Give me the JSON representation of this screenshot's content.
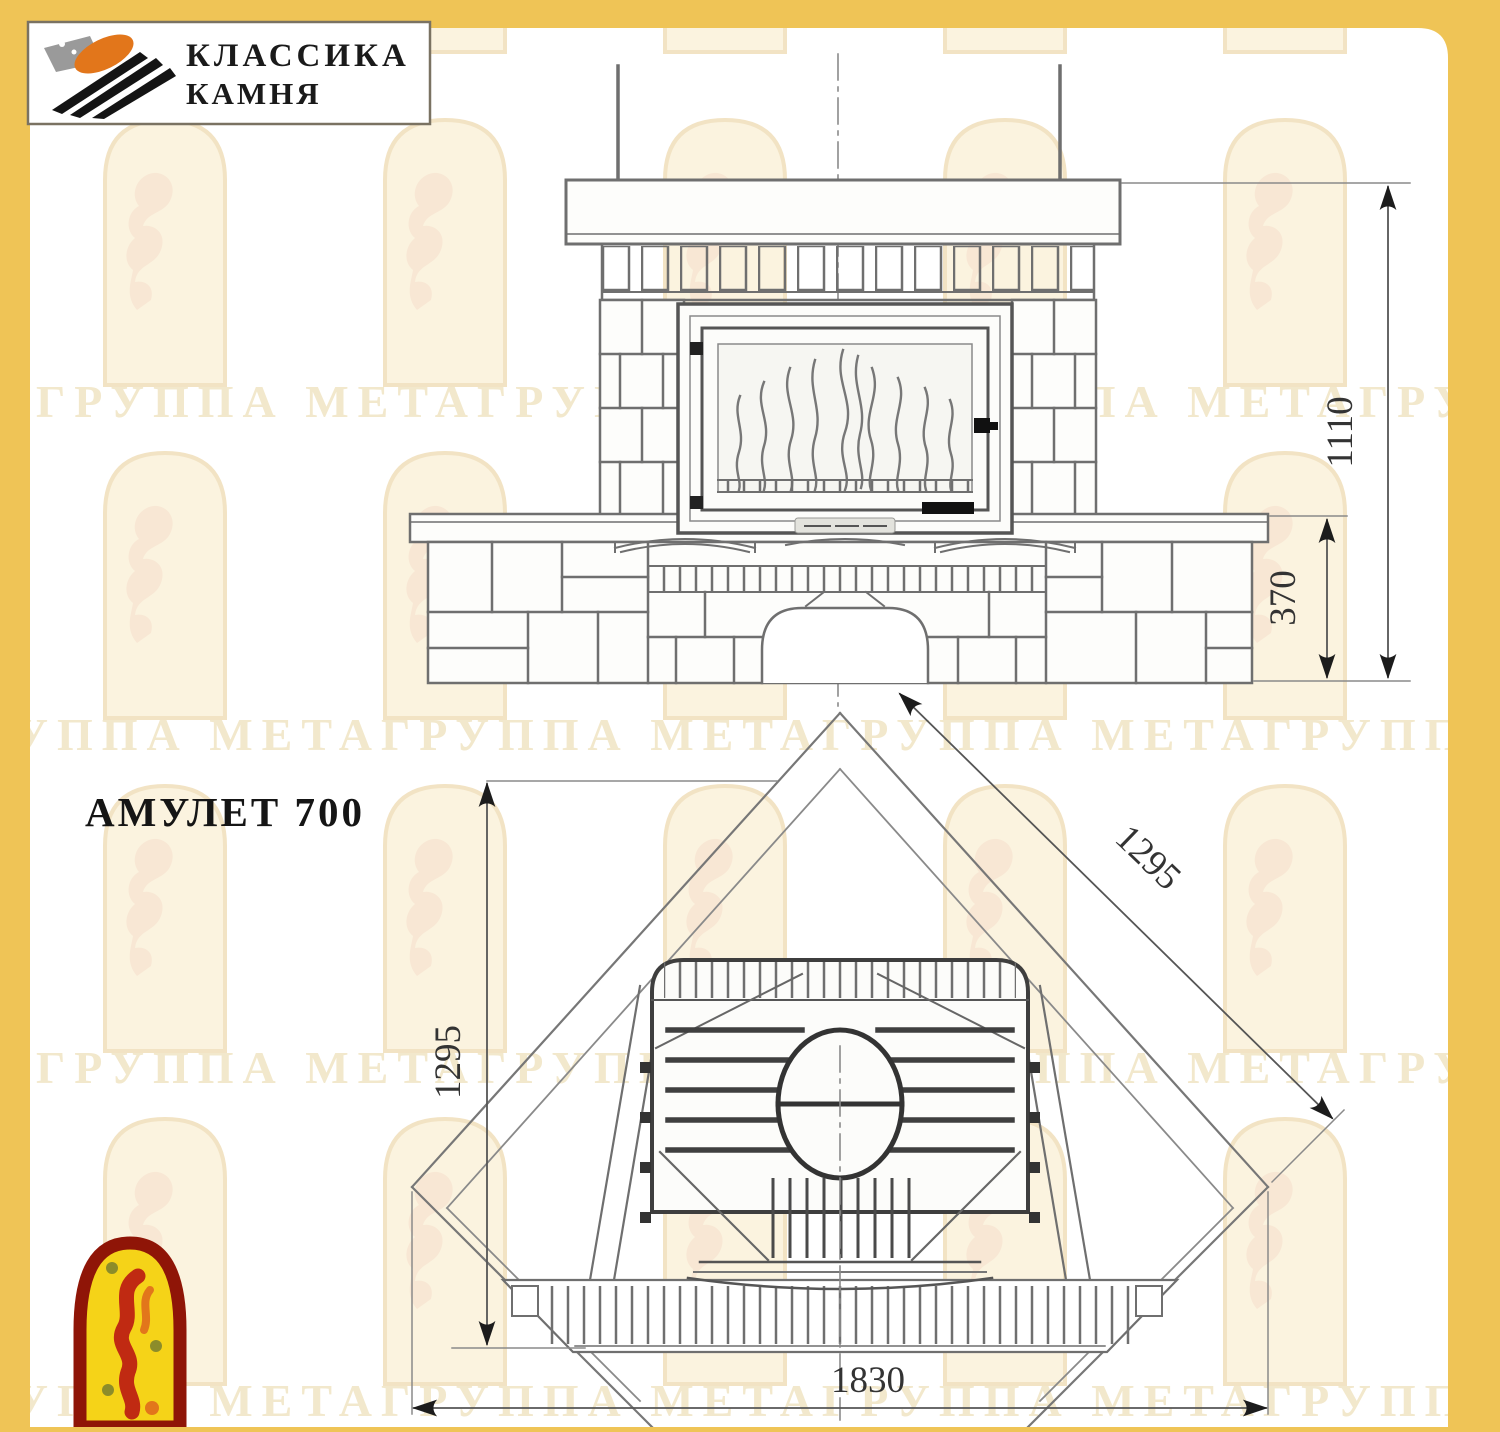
{
  "logo": {
    "line1": "КЛАССИКА",
    "line2": "КАМНЯ"
  },
  "title": "АМУЛЕТ 700",
  "dims": {
    "front_height": "1110",
    "front_bench": "370",
    "plan_left": "1295",
    "plan_diagonal": "1295",
    "plan_width": "1830"
  },
  "dimensions_mm": {
    "front": {
      "height_total": 1110,
      "bench_height": 370
    },
    "plan": {
      "side_left": 1295,
      "side_diagonal": 1295,
      "front_width": 1830
    }
  },
  "watermark": {
    "text": "ГРУППА МЕТАГРУППА МЕТАГРУППА МЕТАГРУППА МЕТАГРУППА МЕТА"
  },
  "colors": {
    "frame_yellow": "#EFC456",
    "paper_white": "#FFFFFF",
    "line_gray": "#6F6F6F",
    "dark_line": "#3E3E3E",
    "arrow_black": "#1C1C1C",
    "watermark_cream": "#F2E8CC",
    "arch_outline": "#F2E3C4",
    "arch_fill": "#FBF3DF",
    "arch_figure": "#F6E2D0",
    "logo_orange": "#E2761B",
    "logo_gray": "#9A9A9A",
    "mascot_border": "#8F1507",
    "mascot_yellow": "#F5D318",
    "mascot_red": "#C02A12"
  }
}
